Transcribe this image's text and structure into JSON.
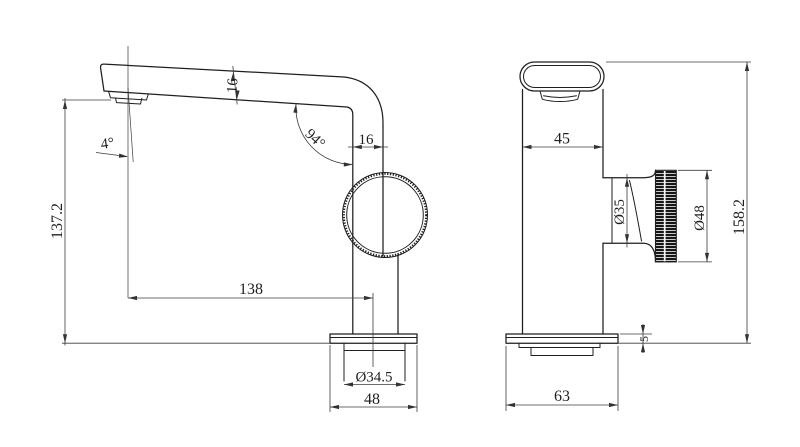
{
  "drawing": {
    "kind": "two-view faucet dimension drawing",
    "background": "#ffffff",
    "line_color": "#1f1f1f",
    "side_view": {
      "height_to_spout": "137.2",
      "spout_tilt_angle": "4°",
      "spout_thickness": "16",
      "bend_angle": "94°",
      "neck_width": "16",
      "spout_reach": "138",
      "shank_diameter": "Ø34.5",
      "base_width": "48"
    },
    "front_view": {
      "body_width": "45",
      "stem_diameter": "Ø35",
      "knob_diameter": "Ø48",
      "overall_height": "158.2",
      "base_plate_thickness": "5",
      "base_width": "63"
    }
  }
}
